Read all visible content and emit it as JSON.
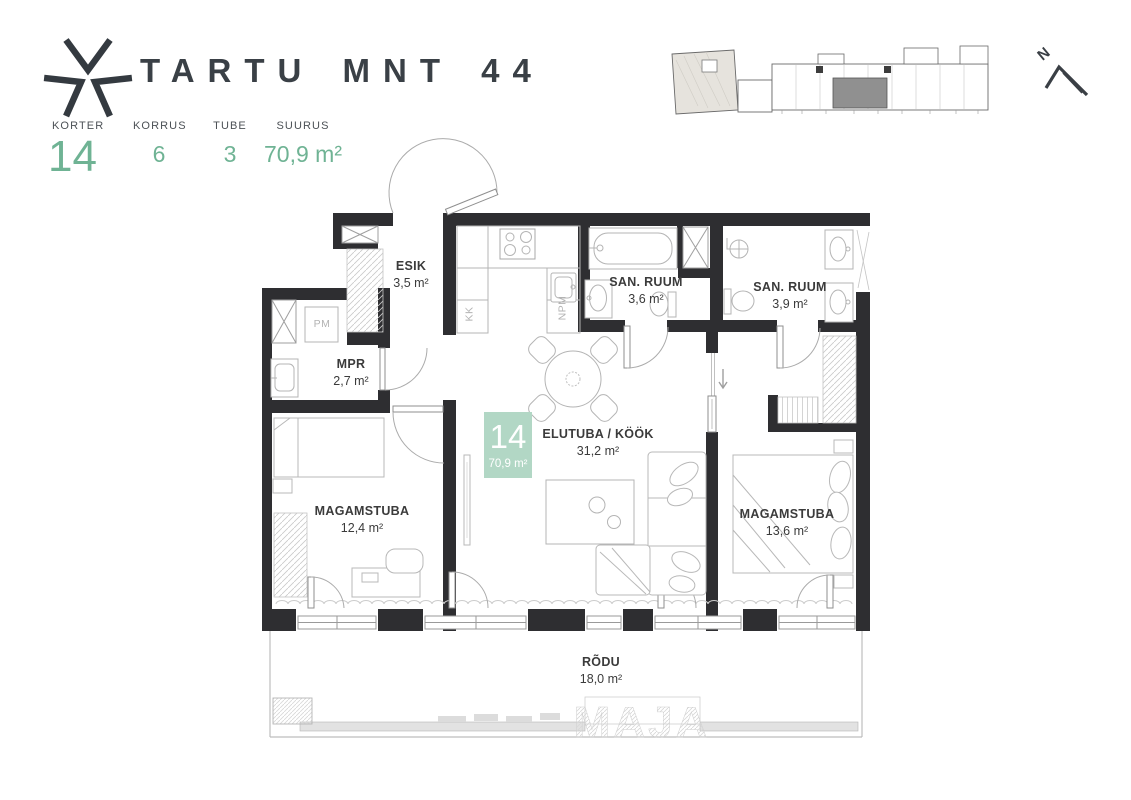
{
  "header": {
    "title": "TARTU MNT 44",
    "stats": [
      {
        "label": "KORTER",
        "value": "14"
      },
      {
        "label": "KORRUS",
        "value": "6"
      },
      {
        "label": "TUBE",
        "value": "3"
      },
      {
        "label": "SUURUS",
        "value": "70,9 m²"
      }
    ]
  },
  "north": {
    "label": "N"
  },
  "unit_badge": {
    "number": "14",
    "area": "70,9 m²"
  },
  "rooms": {
    "esik": {
      "name": "ESIK",
      "area": "3,5 m²"
    },
    "mpr": {
      "name": "MPR",
      "area": "2,7 m²"
    },
    "san1": {
      "name": "SAN. RUUM",
      "area": "3,6 m²"
    },
    "san2": {
      "name": "SAN. RUUM",
      "area": "3,9 m²"
    },
    "elutuba": {
      "name": "ELUTUBA / KÖÖK",
      "area": "31,2 m²"
    },
    "magamistuba1": {
      "name": "MAGAMSTUBA",
      "area": "12,4 m²"
    },
    "magamistuba2": {
      "name": "MAGAMSTUBA",
      "area": "13,6 m²"
    },
    "rodu": {
      "name": "RÕDU",
      "area": "18,0 m²"
    }
  },
  "appliance_labels": {
    "pm": "PM",
    "kk": "KK",
    "npm": "NPM"
  },
  "watermark": {
    "text": "MAJA"
  },
  "colors": {
    "accent_green": "#6fb394",
    "badge_green": "#b2d7c5",
    "wall_dark": "#2e2e31",
    "furniture_line": "#b8b8b8"
  }
}
